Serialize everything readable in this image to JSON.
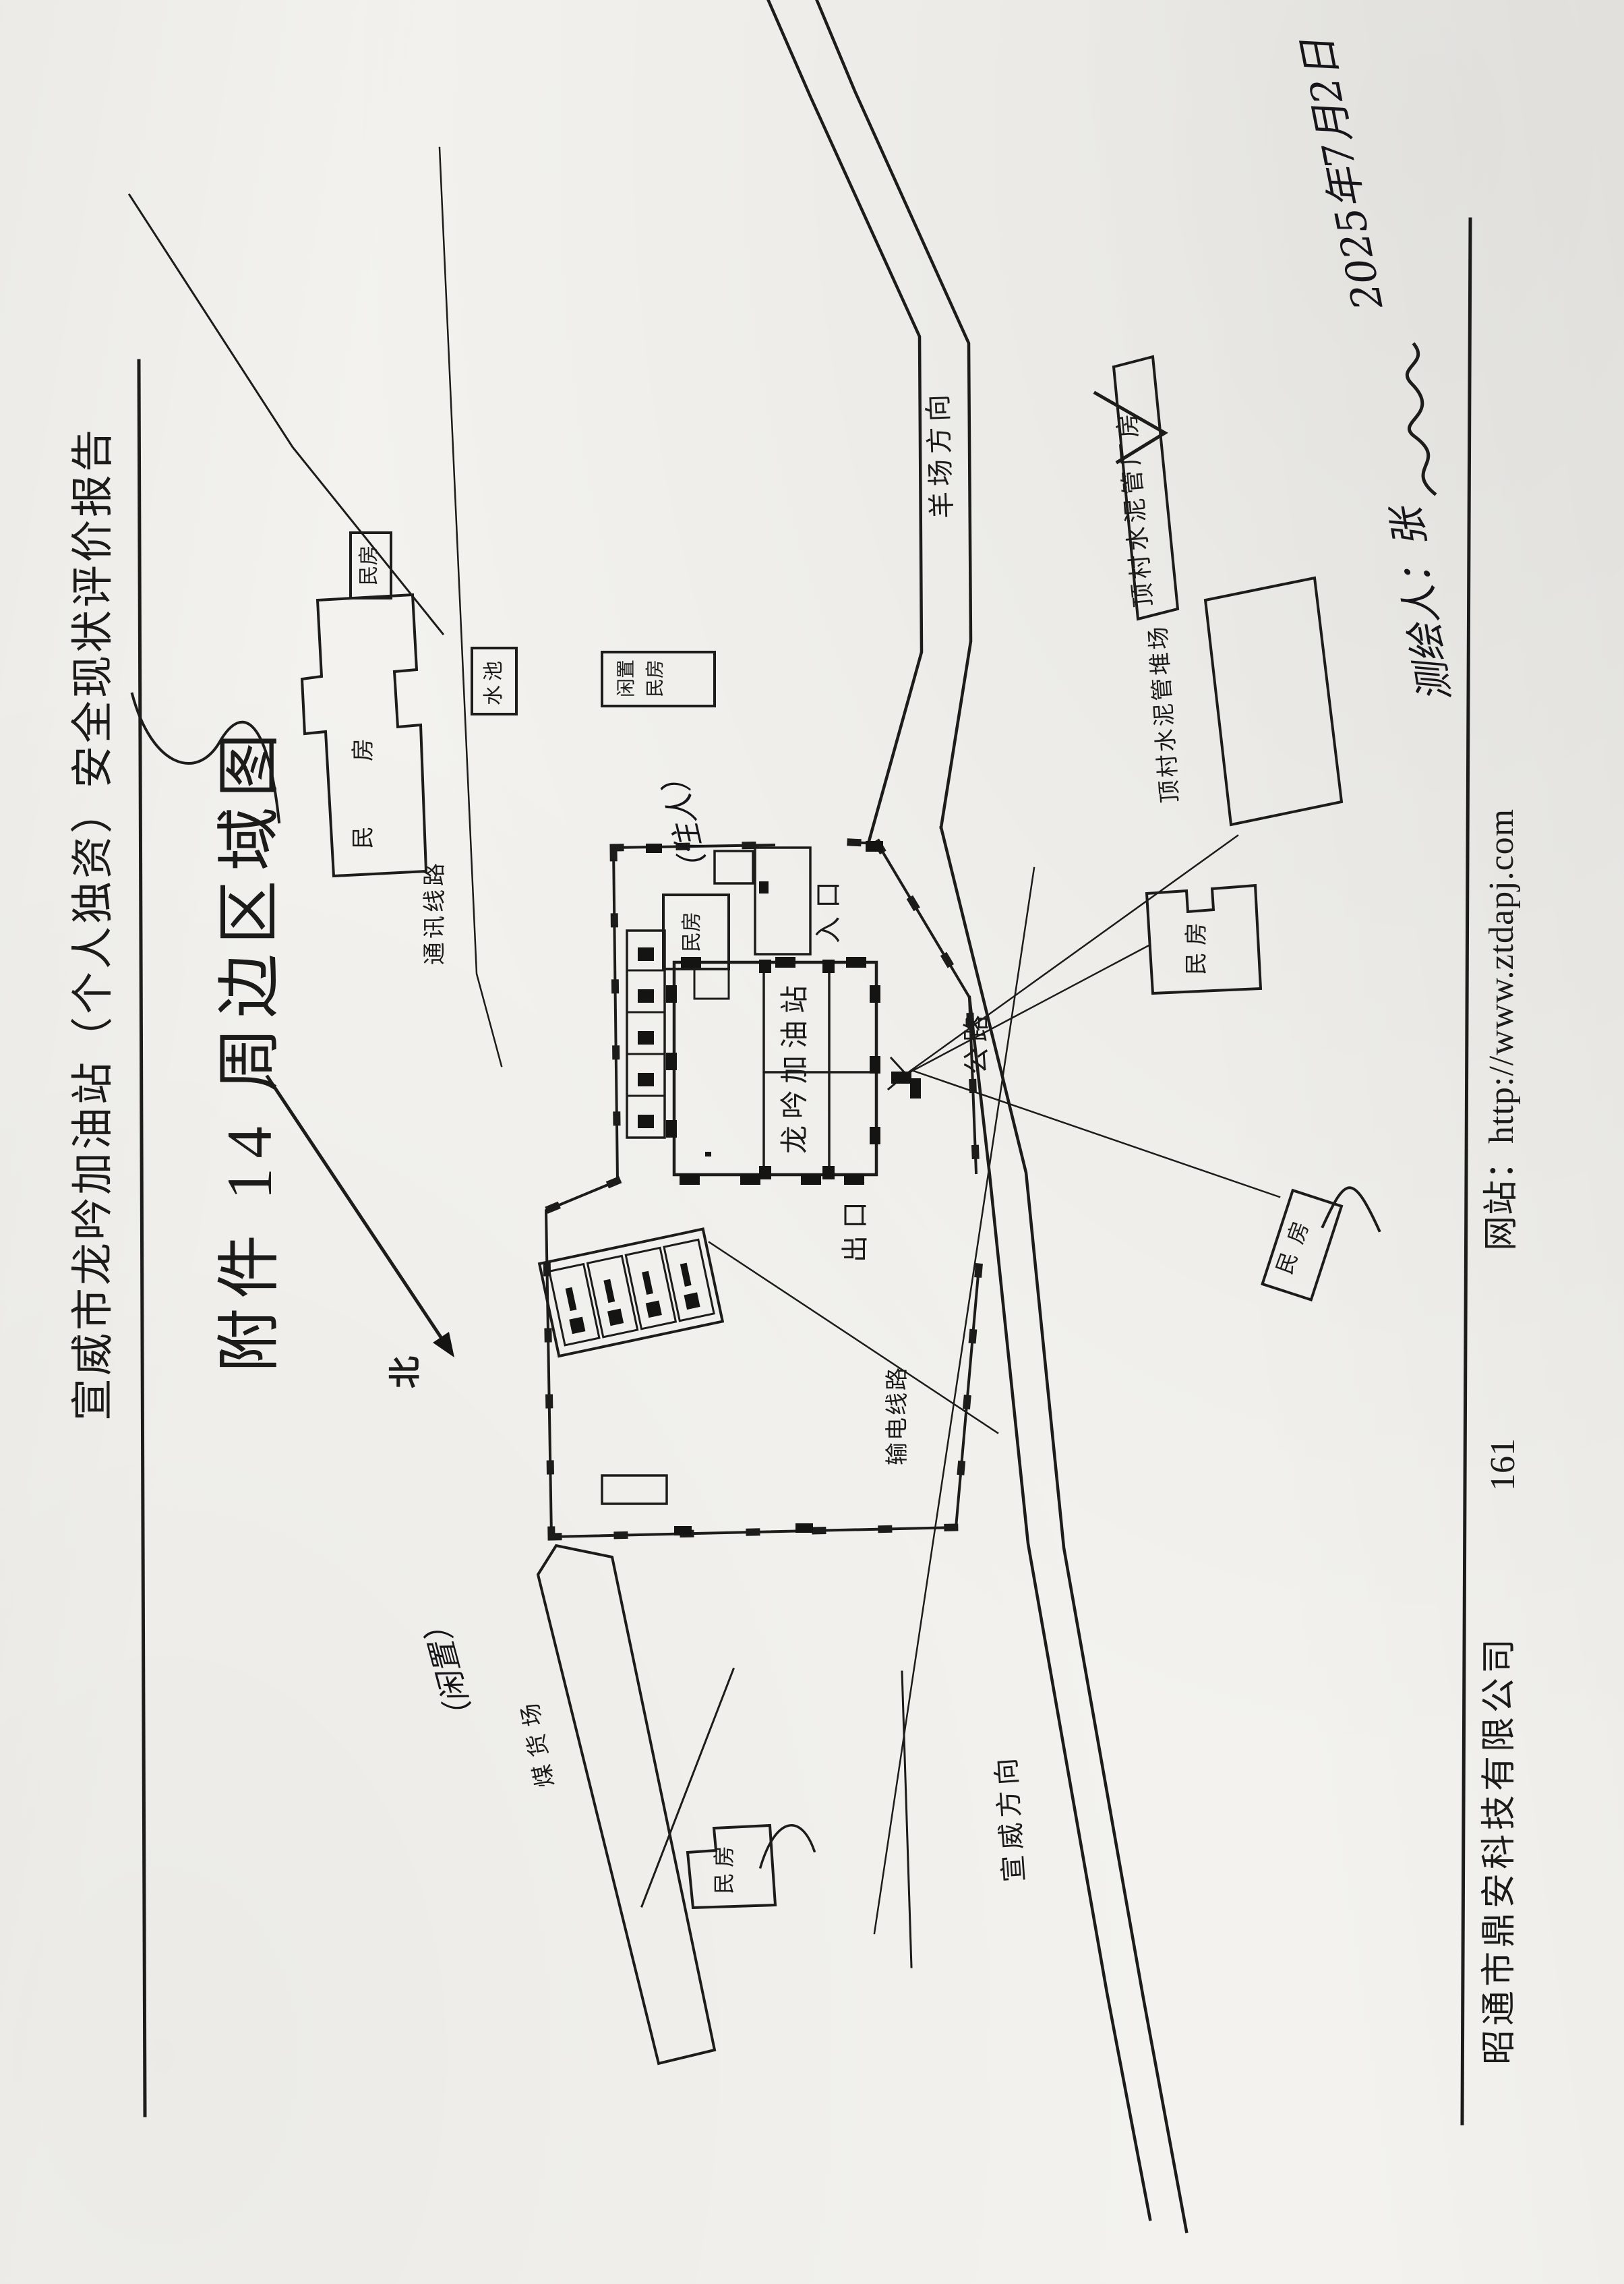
{
  "document": {
    "header_title": "宣威市龙吟加油站（个人独资）安全现状评价报告",
    "attachment_title": "附件 14 周边区域图",
    "footer": {
      "company": "昭通市鼎安科技有限公司",
      "page_number": "161",
      "website_label": "网站：",
      "website_url": "http://www.ztdapj.com"
    },
    "handwriting": {
      "surveyor_line": "测绘人：张",
      "date": "2025年7月2日"
    }
  },
  "map": {
    "north_label": "北",
    "station": {
      "name": "龙吟加油站",
      "entrance": "入口",
      "exit": "出口"
    },
    "roads": {
      "highway": "公路",
      "direction_southwest": "宣威方向",
      "direction_northeast": "羊场方向"
    },
    "utilities": {
      "telecom_line": "通讯线路",
      "power_line": "输电线路"
    },
    "features": {
      "house": "民房",
      "idle_house": "闲置民房",
      "water_pool": "水池",
      "cement_pipe_factory": "顶村水泥管厂房",
      "cement_pipe_stockyard": "顶村水泥管堆场",
      "coal_yard": "煤货场"
    },
    "handwritten_notes": {
      "occupied": "（住人）",
      "idle": "（闲置）"
    }
  }
}
